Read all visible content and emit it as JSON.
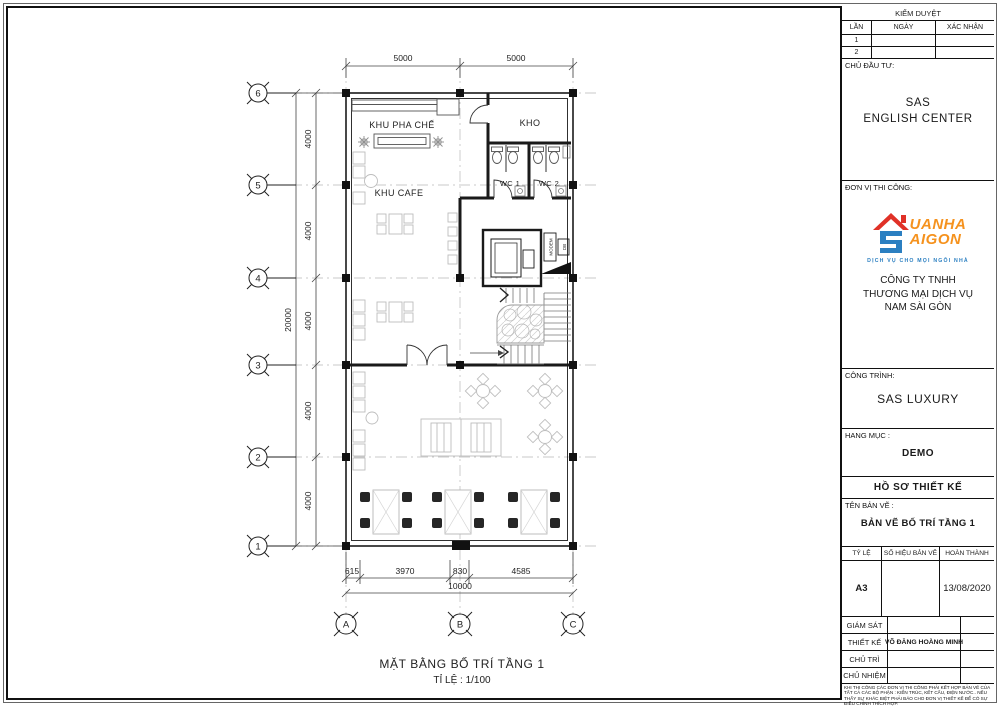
{
  "plan": {
    "rooms": {
      "khu_pha_che": "KHU PHA CHẾ",
      "kho": "KHO",
      "wc1": "WC 1",
      "wc2": "WC 2",
      "khu_cafe": "KHU CAFE",
      "modem": "MODEM",
      "db": "DB"
    },
    "dims": {
      "top": [
        "5000",
        "5000"
      ],
      "left_bays": [
        "4000",
        "4000",
        "4000",
        "4000",
        "4000"
      ],
      "left_total": "20000",
      "bottom": [
        "615",
        "3970",
        "830",
        "4585"
      ],
      "bottom_total": "10000"
    },
    "grid": {
      "rows": [
        "6",
        "5",
        "4",
        "3",
        "2",
        "1"
      ],
      "cols": [
        "A",
        "B",
        "C"
      ]
    },
    "caption": {
      "title": "MẶT BẰNG BỐ TRÍ TẦNG 1",
      "scale": "TỈ LỆ : 1/100"
    }
  },
  "titleblock": {
    "approval": {
      "title": "KIỂM DUYỆT",
      "col_no": "LẦN",
      "col_date": "NGÀY",
      "col_confirm": "XÁC NHẬN",
      "rows": [
        "1",
        "2"
      ]
    },
    "investor": {
      "label": "CHỦ ĐẦU TƯ:",
      "name_line1": "SAS",
      "name_line2": "ENGLISH CENTER"
    },
    "contractor": {
      "label": "ĐƠN VỊ THI CÔNG:",
      "logo": {
        "word1": "UANHA",
        "word2": "AIGON",
        "tagline": "DỊCH VỤ CHO MỌI NGÔI NHÀ"
      },
      "company_line1": "CÔNG TY TNHH",
      "company_line2": "THƯƠNG MẠI DỊCH VỤ",
      "company_line3": "NAM SÀI GÒN"
    },
    "project": {
      "label": "CÔNG TRÌNH:",
      "value": "SAS LUXURY"
    },
    "category": {
      "label": "HANG MỤC :",
      "value": "DEMO"
    },
    "dossier": "HỒ SƠ THIẾT KẾ",
    "drawing": {
      "label": "TÊN BẢN VẼ :",
      "value": "BẢN VẼ BỐ TRÍ TẦNG 1"
    },
    "meta": {
      "col_scale": "TỶ LỆ",
      "col_number": "SỐ HIỆU BẢN VẼ",
      "col_done": "HOÀN THÀNH",
      "scale": "A3",
      "number": "",
      "done": "13/08/2020"
    },
    "staff": [
      {
        "label": "GIÁM SÁT",
        "value": ""
      },
      {
        "label": "THIẾT KẾ",
        "value": "VÕ ĐĂNG HOÀNG MINH"
      },
      {
        "label": "CHỦ TRÌ",
        "value": ""
      },
      {
        "label": "CHỦ NHIỆM",
        "value": ""
      }
    ],
    "note": "KHI THI CÔNG CÁC ĐƠN VỊ THI CÔNG PHẢI KẾT HỢP BẢN VẼ CỦA TẤT CẢ CÁC BỘ PHẬN : KIẾN TRÚC, KẾT CẤU, ĐIỆN NƯỚC.. NẾU THẤY SỰ KHÁC BIỆT PHẢI BÁO CHO ĐƠN VỊ THIẾT KẾ ĐỂ CÓ SỰ ĐIỀU CHỈNH THÍCH HỢP."
  },
  "colors": {
    "logo_red": "#e03127",
    "logo_blue": "#2b7fc1",
    "logo_orange": "#f5921e",
    "line": "#1a1a1a"
  }
}
